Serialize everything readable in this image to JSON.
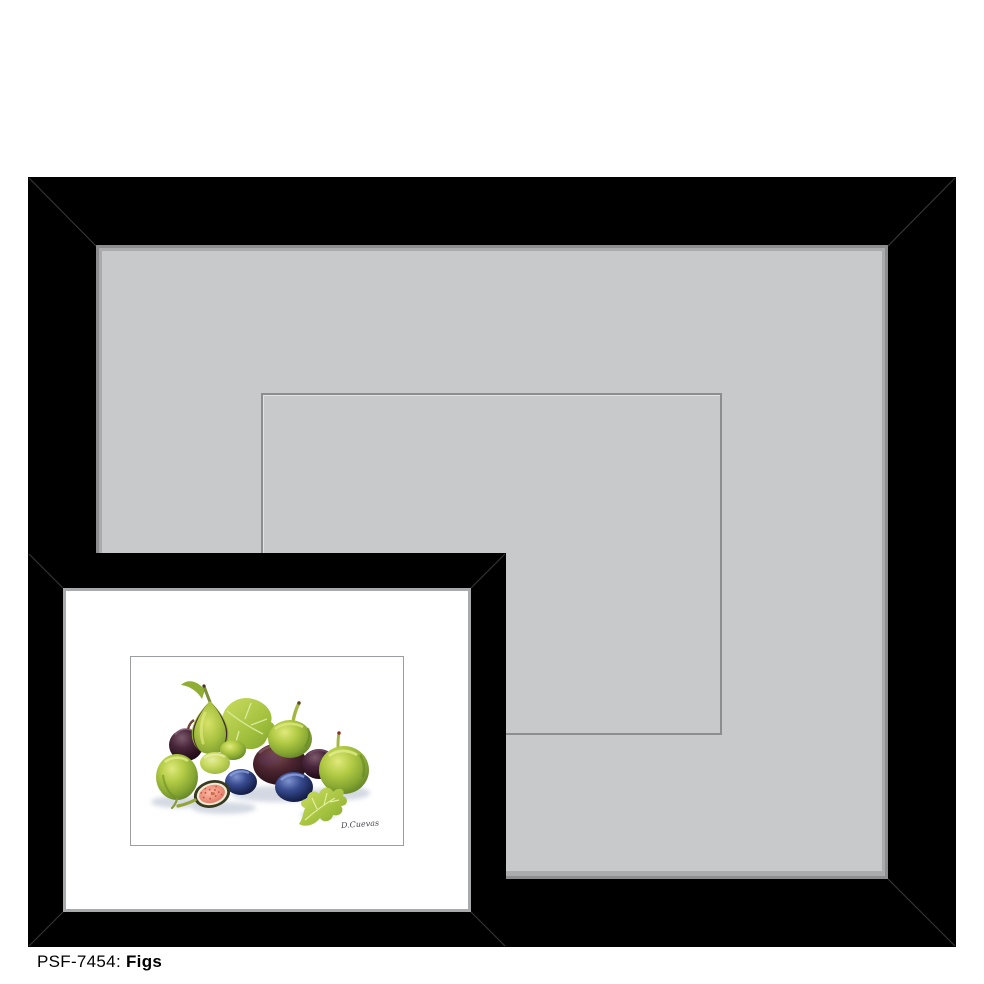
{
  "caption": {
    "label": "PSF-7454:",
    "title": "Figs"
  },
  "product": {
    "code": "PSF-7454",
    "name": "Figs",
    "signature": "D.Cuevas"
  },
  "colors": {
    "frame_black": "#000000",
    "mat_gray": "#c8c9cb",
    "mat_bevel_gray": "#8d8d8f",
    "opening_outline_gray": "#8b8d8f",
    "preview_mat_white": "#ffffff",
    "fig_green": "#9ebc35",
    "fig_dark_purple": "#31182a",
    "fig_blue": "#27356e",
    "fig_flesh_pink": "#ee937e",
    "leaf_green": "#a3c13e"
  }
}
